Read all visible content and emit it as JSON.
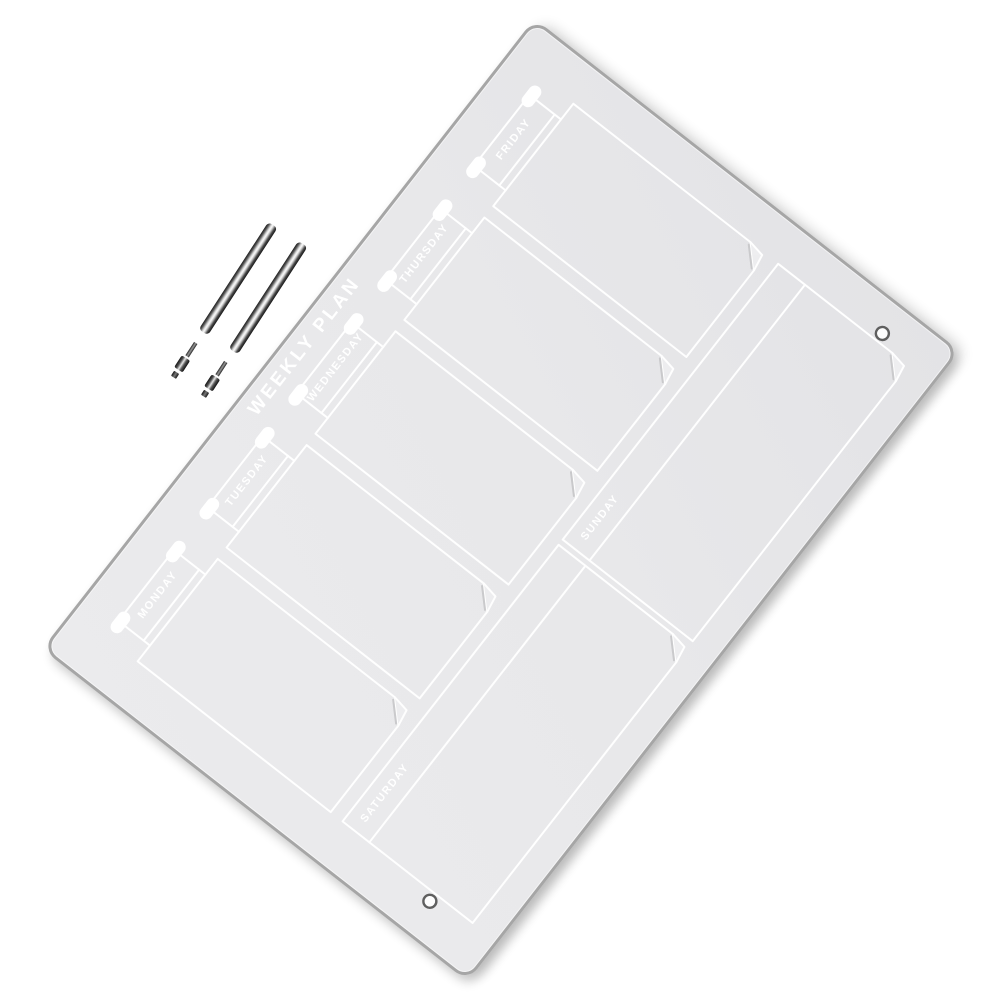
{
  "product": {
    "title": "WEEKLY PLAN",
    "days": [
      "MONDAY",
      "TUESDAY",
      "WEDNESDAY",
      "THURSDAY",
      "FRIDAY",
      "SATURDAY",
      "SUNDAY"
    ]
  },
  "objects": {
    "board": "acrylic-weekly-planner-board",
    "pens": [
      "marker-pen",
      "marker-pen"
    ],
    "holes": [
      "mounting-hole-left",
      "mounting-hole-right"
    ]
  },
  "colors": {
    "background": "#ffffff",
    "board_fill": "#e8e8ea",
    "board_edge": "#a6a6a6",
    "line": "#ffffff",
    "pen_dark": "#1c1c1c",
    "hole_ring": "#5f5f5f"
  }
}
